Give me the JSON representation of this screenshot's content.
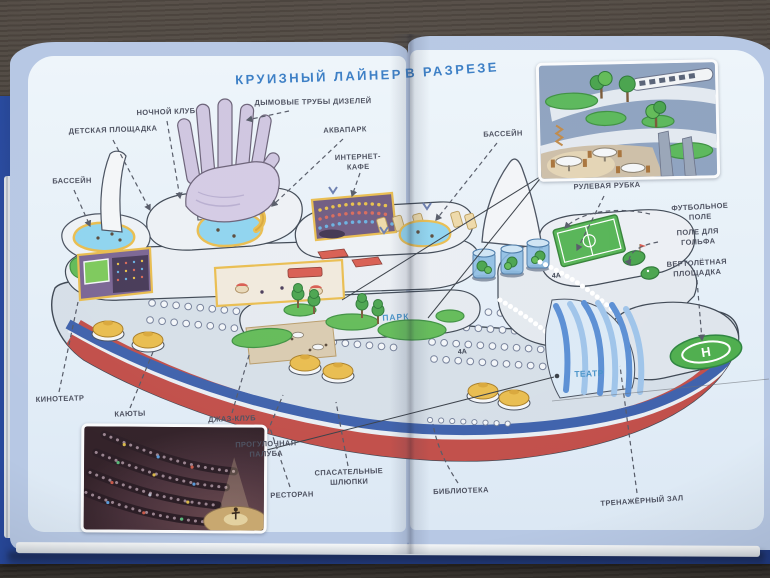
{
  "title": {
    "part1": "КРУИЗНЫЙ ЛАЙНЕР",
    "part2": "В РАЗРЕЗЕ"
  },
  "labels": {
    "playground": {
      "text": "ДЕТСКАЯ ПЛОЩАДКА"
    },
    "night_club": {
      "text": "НОЧНОЙ КЛУБ"
    },
    "smoke_stacks": {
      "text": "ДЫМОВЫЕ ТРУБЫ ДИЗЕЛЕЙ"
    },
    "aquapark": {
      "text": "АКВАПАРК"
    },
    "internet_cafe": {
      "text": "ИНТЕРНЕТ-\nКАФЕ"
    },
    "pool_left": {
      "text": "БАССЕЙН"
    },
    "pool_right": {
      "text": "БАССЕЙН"
    },
    "wheelhouse": {
      "text": "РУЛЕВАЯ РУБКА"
    },
    "football_field": {
      "text": "ФУТБОЛЬНОЕ ПОЛЕ"
    },
    "golf_course": {
      "text": "ПОЛЕ ДЛЯ ГОЛЬФА"
    },
    "helipad": {
      "text": "ВЕРТОЛЁТНАЯ\nПЛОЩАДКА"
    },
    "cinema": {
      "text": "КИНОТЕАТР"
    },
    "cabins": {
      "text": "КАЮТЫ"
    },
    "jazz_club": {
      "text": "ДЖАЗ-КЛУБ"
    },
    "promenade_deck": {
      "text": "ПРОГУЛОЧНАЯ\nПАЛУБА"
    },
    "lifeboats": {
      "text": "СПАСАТЕЛЬНЫЕ\nШЛЮПКИ"
    },
    "restaurant": {
      "text": "РЕСТОРАН"
    },
    "library": {
      "text": "БИБЛИОТЕКА"
    },
    "theater": {
      "text": "ТЕАТР"
    },
    "gym": {
      "text": "ТРЕНАЖЁРНЫЙ ЗАЛ"
    }
  },
  "ship": {
    "park_label": "ПАРК",
    "helipad_letter": "H",
    "deck_markers": [
      "4А",
      "4А"
    ]
  },
  "colors": {
    "title_blue": "#3b7ec5",
    "label_gray": "#4d5160",
    "page_margin_blue": "#b7c8e4",
    "page_inner": "#e8f1f8",
    "cover_blue": "#2a4da4",
    "wood_brown": "#46403a",
    "hull_red": "#c14f4a",
    "hull_stripe_blue": "#3f62ac",
    "water_blue": "#8fd4ef",
    "grass_green": "#5cb85c",
    "helipad_green": "#4fae4e",
    "slide_yellow": "#e9bd4f",
    "funnel_lavender": "#cfc6e0"
  }
}
